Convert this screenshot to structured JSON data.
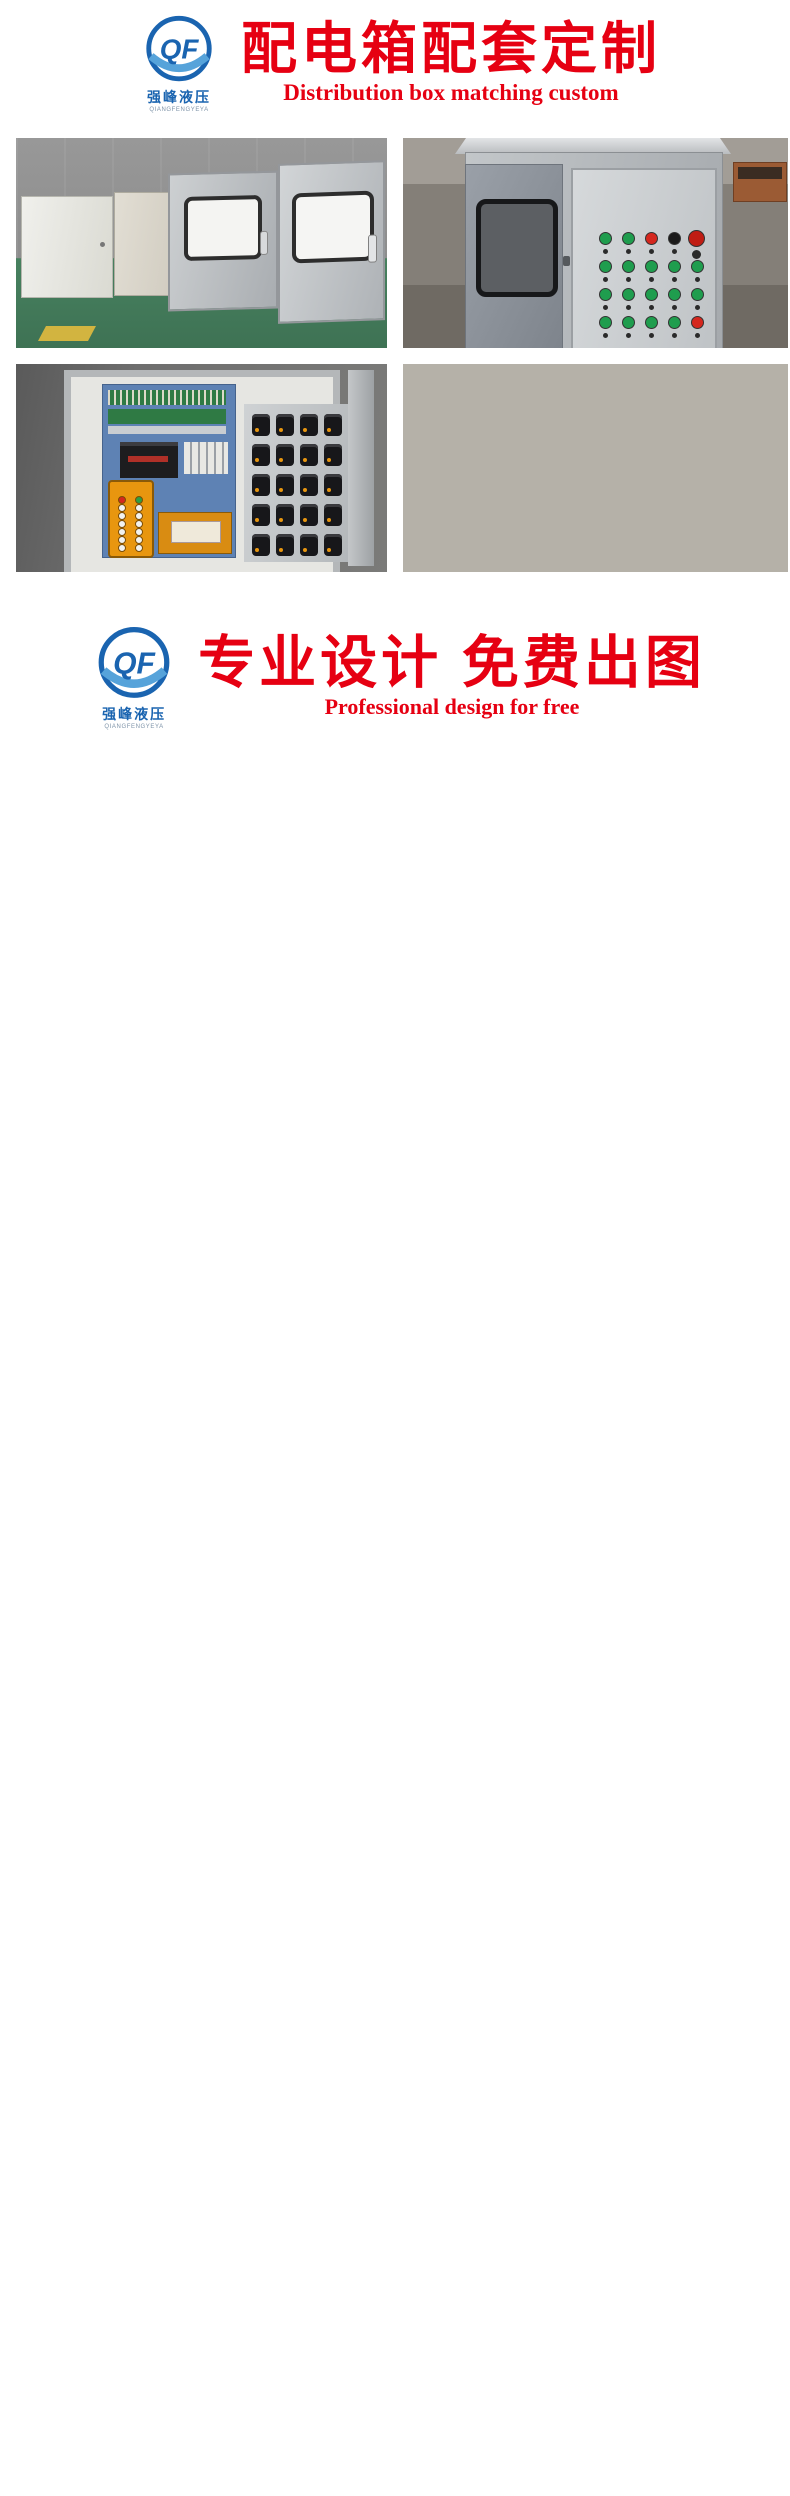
{
  "brand": {
    "mark": "QF",
    "name": "强峰液压",
    "latin": "QIANGFENGYEYA",
    "blue": "#1a64b0",
    "light_blue": "#56a3da"
  },
  "header1": {
    "title": "配电箱配套定制",
    "subtitle": "Distribution box matching custom",
    "accent": "#e60012"
  },
  "header2": {
    "title": "专业设计 免费出图",
    "subtitle": "Professional design for free"
  },
  "photos": {
    "button_colors": {
      "g": "#1f9d4e",
      "r": "#d5271e",
      "k": "#1b1b1b",
      "R": "#c01d14"
    },
    "panel_rows": [
      [
        "g",
        "g",
        "r",
        "k",
        "R"
      ],
      [
        "g",
        "g",
        "g",
        "g",
        "g"
      ],
      [
        "g",
        "g",
        "g",
        "g",
        "g"
      ],
      [
        "g",
        "g",
        "g",
        "g",
        "r"
      ]
    ],
    "stripe_color": "#e23420"
  },
  "drawing1": {
    "grid_cols": [
      "1",
      "2",
      "3",
      "4",
      "5",
      "6"
    ],
    "grid_rows": [
      "A",
      "B",
      "C",
      "D"
    ],
    "cyl_labels": [
      "A组",
      "A组",
      "B组",
      "B组",
      "B组",
      "B组",
      "A组",
      "A组"
    ],
    "bom_rows": [
      [
        "1",
        "电机",
        "11KW-4P-B35",
        "台",
        "2",
        "东营电机"
      ],
      [
        "2",
        "油泵",
        "PVL12-25/65",
        "台",
        "2",
        "DONGCLX"
      ],
      [
        "3",
        "法兰架",
        "法兰架/连轴器",
        "套",
        "2",
        "DONGCLX"
      ],
      [
        "4",
        "单向阀",
        "CRG-06",
        "个",
        "2",
        "DONGCLX"
      ],
      [
        "5",
        "单向阀",
        "CRG-10",
        "个",
        "2",
        "DONGCLX"
      ],
      [
        "6",
        "溢流阀",
        "SRV-06G-DC24V",
        "个",
        "2",
        "DONGCLX"
      ],
      [
        "7",
        "换向阀",
        "DS-06-3C4-DC24V",
        "个",
        "8",
        "DONGCLX"
      ],
      [
        "8",
        "保压阀",
        "PCV-06G",
        "个",
        "4",
        "DONGCLX"
      ],
      [
        "9",
        "压表阀",
        "IG-06",
        "个",
        "2",
        "DONGCLX"
      ],
      [
        "10",
        "电磁阀",
        "DSG-03-3C2-DC24V",
        "个",
        "2",
        "DONGCLX"
      ],
      [
        "11",
        "节流阀",
        "MTCV-03W",
        "个",
        "2",
        "DONGCLX"
      ],
      [
        "12",
        "减压阀",
        "MBRV-03-P-2",
        "个",
        "2",
        "DONGCLX"
      ],
      [
        "13",
        "油路板",
        "06-10W",
        "块",
        "2",
        "DONGCLX"
      ],
      [
        "14",
        "油路板",
        "03-2W",
        "块",
        "1",
        "DONGCLX"
      ],
      [
        "15",
        "水冷",
        "OR-350",
        "台",
        "2",
        "DONGCLX"
      ],
      [
        "16",
        "油箱",
        "400L",
        "个",
        "1",
        "DONGCLX"
      ],
      [
        "17",
        "压力继电器",
        "JCS-02N",
        "个",
        "8",
        "DONGCLX"
      ],
      [
        "18",
        "配件",
        "接头、油尺等",
        "套",
        "1",
        "DONGCLX"
      ]
    ],
    "tb": {
      "customer_l": "客户",
      "customer": "中铁八局",
      "audit_l": "审核",
      "auditor": "宋易明",
      "draft_l": "制图",
      "drafter": "晔勐",
      "date_l": "日期",
      "date": "2018.08.09",
      "view_l": "视 角",
      "part_l": "零件名称",
      "part": "",
      "mat_l": "材 料",
      "scale_l": "比 例",
      "scale": "1:1",
      "company": "东营市强峰液压装备有限公司",
      "gname_l": "总图名称",
      "gname": "桥梁模板专用液压系统",
      "qty_l": "数量",
      "page": "第 1 页  共 1 页"
    }
  },
  "drawing2": {
    "labels": {
      "valve1": "0811403017",
      "valve2": "0811403017",
      "valve3": "0811403017",
      "relief": "SRV-03G"
    },
    "port_p": "P",
    "port_t": "T",
    "port_b": "B",
    "port_a": "A",
    "grid_rows": [
      "C",
      "B",
      "A"
    ],
    "tb": {
      "pn_l": "品名",
      "pn": "订制油路板",
      "model_l": "型号",
      "model": "02-8W/03-3W/BSG03",
      "size_l": "尺寸",
      "company": "东营市强峰液压",
      "design_l": "设计",
      "date_l": "日期",
      "date": "17/11/30",
      "plug_l": "塞头",
      "plug": "11个",
      "page1": "页 次",
      "draft_l": "绘图",
      "mat_l": "材料",
      "page2": "共 页 第",
      "audit_l": "审核",
      "proj_l": "投影",
      "proj": "第三角",
      "unit_l": "单位",
      "unit": "mm"
    }
  },
  "drawing3": {
    "grid_cols": [
      "1",
      "2",
      "3",
      "4",
      "5",
      "6"
    ],
    "grid_rows": [
      "A",
      "B",
      "C",
      "D"
    ],
    "dims": {
      "overall": "1635",
      "top": [
        "50",
        "60",
        "45",
        "155",
        "45",
        "655",
        "45",
        "155",
        "45",
        "265"
      ],
      "left_offset": "115",
      "pin": "82",
      "radius": "R80",
      "bottom": [
        "203",
        "1000",
        "252",
        "65"
      ],
      "bore": "Ø250",
      "flange": "80"
    },
    "specs": [
      "缸径: 320",
      "杆径: 220",
      "行程: 1200",
      "系统压力: 35MPA"
    ],
    "tb": {
      "customer_l": "客户",
      "customer": "中铁八局",
      "audit_l": "审核",
      "auditor": "宋易明",
      "draft_l": "制图",
      "drafter": "晔勐",
      "date_l": "日期",
      "date": "2018.08.12",
      "view_l": "视 角",
      "part_l": "零件名称",
      "part": "工程专用液压油缸",
      "mat_l": "材 料",
      "scale_l": "比 例",
      "scale": "1:1",
      "company": "东营市强峰液压装备有限公司",
      "gname_l": "总图名称",
      "gname": "桥梁模板专用液压油缸",
      "qty_l": "数量",
      "page": "第 1 页  共 1 页"
    }
  }
}
